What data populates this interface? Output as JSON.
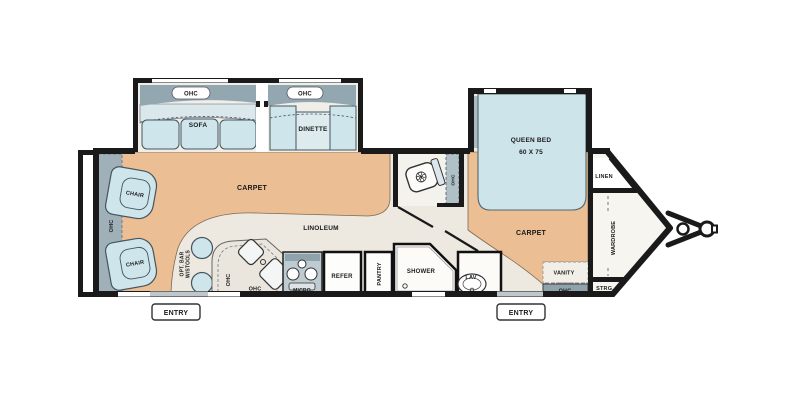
{
  "floorplan": {
    "type": "travel-trailer-floorplan",
    "labels": {
      "ohc_sofa": "OHC",
      "ohc_dinette": "OHC",
      "sofa": "SOFA",
      "dinette": "DINETTE",
      "queen_bed": "QUEEN BED",
      "queen_bed_size": "60 X 75",
      "linen": "LINEN",
      "wardrobe": "WARDROBE",
      "strg": "STRG.",
      "vanity": "VANITY",
      "ohc_bedroom": "OHC",
      "carpet_living": "CARPET",
      "carpet_bedroom": "CARPET",
      "linoleum": "LINOLEUM",
      "chair_upper": "CHAIR",
      "chair_lower": "CHAIR",
      "ohc_rear": "OHC",
      "opt_bar_line1": "OPT. BAR",
      "opt_bar_line2": "W/STOOLS",
      "ohc_counter_v": "OHC",
      "ohc_counter_h": "OHC",
      "micro": "MICRO",
      "refer": "REFER",
      "pantry": "PANTRY",
      "shower": "SHOWER",
      "lav": "LAV",
      "ohc_bath": "OHC",
      "entry_left": "ENTRY",
      "entry_right": "ENTRY"
    },
    "colors": {
      "wall": "#1a1a1a",
      "carpet": "#EBBE93",
      "linoleum": "#EDE9E1",
      "nose_floor": "#F7F5F0",
      "furniture_blue": "#CFE5EC",
      "furniture_back": "#DAE7EB",
      "cabinet_gray": "#8FA3AD",
      "jamb_gray": "#ACBCC3",
      "counter": "#EAE6DD"
    }
  }
}
